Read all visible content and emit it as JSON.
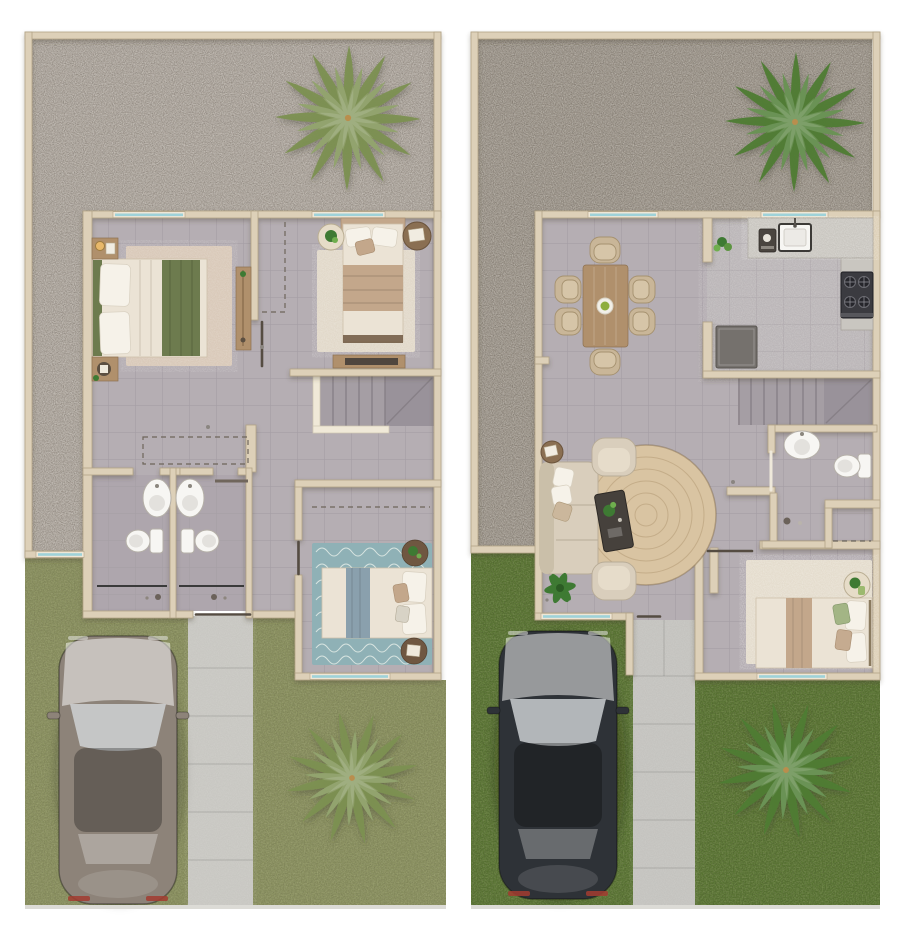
{
  "scene": {
    "type": "top-down architectural floor plan rendering, two panels side by side",
    "panels": [
      {
        "id": "upper-floor-plan",
        "position": "left",
        "outdoor": {
          "back_patio": "gravel patio with one palm tree",
          "side_strip": "gravel side yard along left wall",
          "front_yard": "olive-green lawn, concrete walkway, parked silver car, palm tree"
        },
        "rooms": [
          {
            "name": "bedroom-1",
            "furniture": [
              "double-bed-green-throw",
              "nightstand-with-lamp",
              "nightstand-with-tray",
              "area-rug",
              "wardrobe-shelf"
            ]
          },
          {
            "name": "bedroom-2",
            "furniture": [
              "double-bed-tan-throw",
              "round-table-plant",
              "round-table-books",
              "area-rug",
              "closet-dashed-outline",
              "console-shelf"
            ]
          },
          {
            "name": "bathroom-1",
            "furniture": [
              "oval-sink",
              "toilet",
              "shower-with-glass-screen"
            ]
          },
          {
            "name": "bathroom-2",
            "furniture": [
              "oval-sink",
              "toilet",
              "shower-with-glass-screen",
              "towel-rail"
            ]
          },
          {
            "name": "bedroom-3",
            "furniture": [
              "double-bed-blue-throw",
              "teal-wave-rug",
              "round-table-plant",
              "round-table-tray",
              "closet-dashed-outline"
            ]
          },
          {
            "name": "hallway",
            "furniture": []
          },
          {
            "name": "stairwell",
            "furniture": [
              "staircase-6-treads",
              "landing",
              "railing"
            ]
          }
        ],
        "windows": 5,
        "entry_doors": 1
      },
      {
        "id": "ground-floor-plan",
        "position": "right",
        "outdoor": {
          "back_patio": "dark gravel patio with one palm tree",
          "side_strip": "gravel side yard along left wall",
          "front_yard": "dark green lawn, concrete walkway, parked charcoal car, palm tree"
        },
        "rooms": [
          {
            "name": "dining-room",
            "furniture": [
              "wood-dining-table",
              "six-chairs",
              "serving-plate"
            ]
          },
          {
            "name": "kitchen",
            "furniture": [
              "l-shaped-counter",
              "square-sink",
              "coffee-maker",
              "potted-plant",
              "gas-stove-4-burners",
              "refrigerator"
            ]
          },
          {
            "name": "living-room",
            "furniture": [
              "sofa",
              "armchair-top",
              "armchair-bottom",
              "round-jute-rug",
              "dark-coffee-table",
              "side-table-book",
              "floor-plant"
            ]
          },
          {
            "name": "bathroom",
            "furniture": [
              "oval-sink",
              "toilet"
            ]
          },
          {
            "name": "shower-utility",
            "furniture": [
              "shower-head",
              "dashed-storage-outline"
            ]
          },
          {
            "name": "bedroom",
            "furniture": [
              "double-bed-tan-runner",
              "area-rug",
              "round-table-plant"
            ]
          },
          {
            "name": "stairwell",
            "furniture": [
              "staircase-7-treads",
              "diagonal-landing"
            ]
          }
        ],
        "windows": 4,
        "entry_doors": 1
      }
    ],
    "counts": {
      "palm_trees": 4,
      "cars": 2,
      "dining_chairs": 6,
      "bathrooms_total": 3,
      "beds_total": 4
    }
  },
  "palette": {
    "wall": "#ddd0b8",
    "wall_edge": "#b2a386",
    "floor": "#b5aeb3",
    "floor_bath": "#a8a1a7",
    "stair": "#a59ea4",
    "stair_landing": "#99929a",
    "stair_line": "#878087",
    "railing": "#f0e9d8",
    "glass": "#9ed2d9",
    "glass_frame": "#efe7d6",
    "gravel_left": "#b1a9a0",
    "gravel_right": "#a1998e",
    "grass_left": "#8b9260",
    "grass_right": "#587531",
    "path_left": "#c8c7c2",
    "path_right": "#c4c3bf",
    "rug_cream": "#d9c9b9",
    "rug_light": "#e1d8c9",
    "rug_teal": "#8fb1b6",
    "rug_jute": "#d9c4a2",
    "rug_bedroom_b": "#e4dccd",
    "wood": "#b0906c",
    "wood_dark": "#6f5741",
    "bed_cream": "#ebe3d5",
    "pillow_white": "#f6f2e9",
    "blanket_green": "#6d7b4e",
    "blanket_tan": "#c3a78b",
    "blanket_blue": "#8aa0ad",
    "sofa": "#d9cebc",
    "chair": "#c9b698",
    "table_dark": "#46413c",
    "counter": "#c9c6c0",
    "sink_white": "#f7f6f3",
    "appliance_dark": "#3b3b40",
    "fridge": "#75716d",
    "car_silver": "#8d8379",
    "car_dark": "#2e3237",
    "palm_olive": "#7d9152",
    "palm_green": "#4e7d33",
    "plant": "#3e7a33"
  }
}
